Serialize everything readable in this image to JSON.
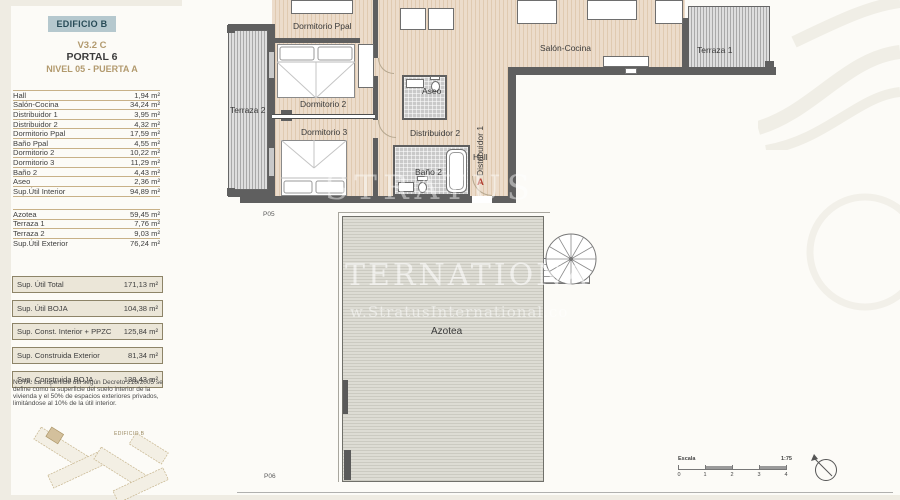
{
  "header": {
    "building": "EDIFICIO B",
    "version": "V3.2 C",
    "portal": "PORTAL 6",
    "level": "NIVEL 05 - PUERTA A"
  },
  "tables": {
    "interior": {
      "rows": [
        {
          "label": "Hall",
          "value": "1,94 m²"
        },
        {
          "label": "Salón-Cocina",
          "value": "34,24 m²"
        },
        {
          "label": "Distribuidor 1",
          "value": "3,95 m²"
        },
        {
          "label": "Distribuidor 2",
          "value": "4,32 m²"
        },
        {
          "label": "Dormitorio Ppal",
          "value": "17,59 m²"
        },
        {
          "label": "Baño Ppal",
          "value": "4,55 m²"
        },
        {
          "label": "Dormitorio 2",
          "value": "10,22 m²"
        },
        {
          "label": "Dormitorio 3",
          "value": "11,29 m²"
        },
        {
          "label": "Baño 2",
          "value": "4,43 m²"
        },
        {
          "label": "Aseo",
          "value": "2,36 m²"
        },
        {
          "label": "Sup.Útil Interior",
          "value": "94,89 m²"
        }
      ]
    },
    "exterior": {
      "rows": [
        {
          "label": "Azotea",
          "value": "59,45 m²"
        },
        {
          "label": "Terraza 1",
          "value": "7,76 m²"
        },
        {
          "label": "Terraza 2",
          "value": "9,03 m²"
        },
        {
          "label": "Sup.Útil Exterior",
          "value": "76,24 m²"
        }
      ]
    },
    "summary": {
      "rows": [
        {
          "label": "Sup. Útil Total",
          "value": "171,13 m²"
        },
        {
          "label": "Sup. Útil BOJA",
          "value": "104,38 m²"
        },
        {
          "label": "Sup. Const. Interior + PPZC",
          "value": "125,84 m²"
        },
        {
          "label": "Sup. Construida Exterior",
          "value": "81,34 m²"
        },
        {
          "label": "Sup. Construida BOJA",
          "value": "138,43 m²"
        }
      ]
    }
  },
  "nota": "NOTA: La superficie útil según Decreto 218/2005 se define como la superficie del suelo interior de la vivienda y el 50% de espacios exteriores privados, limitándose al 10% de la útil interior.",
  "keyplan": {
    "label": "EDIFICIO B"
  },
  "plans": {
    "upper": {
      "sheet": "P05",
      "rooms": {
        "dormitorio_ppal": "Dormitorio Ppal",
        "dormitorio_2": "Dormitorio 2",
        "dormitorio_3": "Dormitorio 3",
        "terraza_2": "Terraza 2",
        "terraza_1": "Terraza 1",
        "salon_cocina": "Salón-Cocina",
        "aseo": "Aseo",
        "distribuidor_1": "Distribuidor 1",
        "distribuidor_2": "Distribuidor 2",
        "hall": "Hall",
        "bano_2": "Baño 2"
      },
      "door_letter": "A"
    },
    "lower": {
      "sheet": "P06",
      "room": "Azotea"
    }
  },
  "scalebar": {
    "label": "Escala",
    "ratio": "1:75",
    "ticks": [
      "0",
      "1",
      "2",
      "3",
      "4"
    ]
  },
  "watermark": {
    "line1": "TERNATIONA",
    "line2": "w.StratusInternational.co",
    "line3": "STRATUS"
  },
  "colors": {
    "accent_tan": "#b29a6e",
    "header_bg": "#b5c8ce",
    "header_text": "#274b57",
    "wall": "#5f5f5f",
    "door_letter_red": "#b03a2e"
  }
}
